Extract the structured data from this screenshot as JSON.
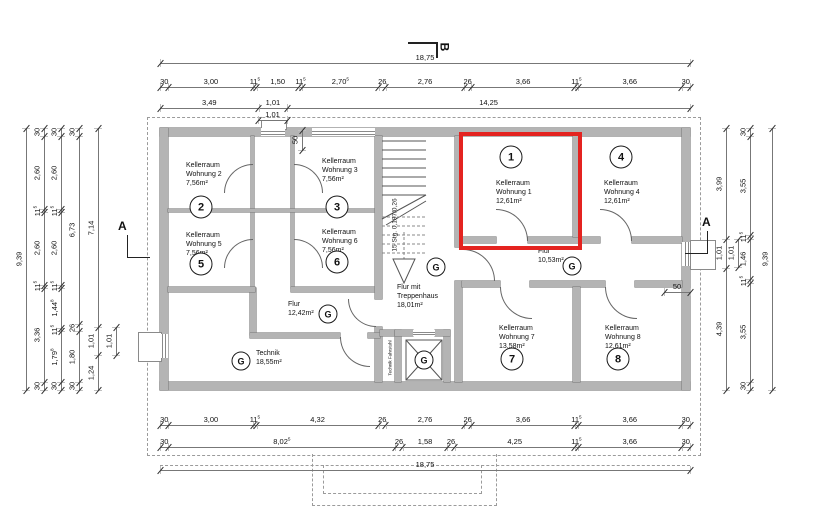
{
  "markers": {
    "a": "A",
    "b": "B"
  },
  "symbols": {
    "drain": "G"
  },
  "rooms": {
    "r1": {
      "circle": "1",
      "line1": "Kellerraum",
      "line2": "Wohnung 1",
      "area": "12,61m²"
    },
    "r2": {
      "circle": "2",
      "line1": "Kellerraum",
      "line2": "Wohnung 2",
      "area": "7,56m²"
    },
    "r3": {
      "circle": "3",
      "line1": "Kellerraum",
      "line2": "Wohnung 3",
      "area": "7,56m²"
    },
    "r4": {
      "circle": "4",
      "line1": "Kellerraum",
      "line2": "Wohnung 4",
      "area": "12,61m²"
    },
    "r5": {
      "circle": "5",
      "line1": "Kellerraum",
      "line2": "Wohnung 5",
      "area": "7,56m²"
    },
    "r6": {
      "circle": "6",
      "line1": "Kellerraum",
      "line2": "Wohnung 6",
      "area": "7,56m²"
    },
    "r7": {
      "circle": "7",
      "line1": "Kellerraum",
      "line2": "Wohnung 7",
      "area": "13,58m²"
    },
    "r8": {
      "circle": "8",
      "line1": "Kellerraum",
      "line2": "Wohnung 8",
      "area": "12,61m²"
    }
  },
  "corridors": {
    "flur1": {
      "name": "Flur",
      "area": "10,53m²"
    },
    "flur2": {
      "name": "Flur",
      "area": "12,42m²"
    },
    "technik": {
      "name": "Technik",
      "area": "18,55m²"
    },
    "treppe": {
      "line1": "Flur mit",
      "line2": "Treppenhaus",
      "area": "18,01m²"
    }
  },
  "stair": {
    "note": "15 Stg. 0,187/0,26"
  },
  "elevator": {
    "note": "Technik Fahrstuhl"
  },
  "dims": [
    {
      "id": "top1",
      "items": [
        {
          "l": "18,75",
          "v": 18.75
        }
      ]
    },
    {
      "id": "top2",
      "items": [
        {
          "l": "30",
          "v": 0.3
        },
        {
          "l": "3,00",
          "v": 3.0
        },
        {
          "l": "11",
          "s": "5",
          "v": 0.115
        },
        {
          "l": "1,50",
          "v": 1.5
        },
        {
          "l": "11",
          "s": "5",
          "v": 0.115
        },
        {
          "l": "2,70",
          "s": "5",
          "v": 2.705
        },
        {
          "l": "26",
          "v": 0.26
        },
        {
          "l": "2,76",
          "v": 2.76
        },
        {
          "l": "26",
          "v": 0.26
        },
        {
          "l": "3,66",
          "v": 3.66
        },
        {
          "l": "11",
          "s": "5",
          "v": 0.115
        },
        {
          "l": "3,66",
          "v": 3.66
        },
        {
          "l": "30",
          "v": 0.3
        }
      ]
    },
    {
      "id": "top3",
      "items": [
        {
          "l": "3,49",
          "v": 3.49
        },
        {
          "l": "1,01",
          "v": 1.01
        },
        {
          "l": "14,25",
          "v": 14.25
        }
      ]
    },
    {
      "id": "top4",
      "items": [
        {
          "l": "1,01",
          "v": 1.01
        }
      ]
    },
    {
      "id": "top50",
      "items": [
        {
          "l": "50",
          "v": 0.5
        }
      ]
    },
    {
      "id": "bot1",
      "items": [
        {
          "l": "30",
          "v": 0.3
        },
        {
          "l": "3,00",
          "v": 3.0
        },
        {
          "l": "11",
          "s": "5",
          "v": 0.115
        },
        {
          "l": "4,32",
          "v": 4.32
        },
        {
          "l": "26",
          "v": 0.26
        },
        {
          "l": "2,76",
          "v": 2.76
        },
        {
          "l": "26",
          "v": 0.26
        },
        {
          "l": "3,66",
          "v": 3.66
        },
        {
          "l": "11",
          "s": "5",
          "v": 0.115
        },
        {
          "l": "3,66",
          "v": 3.66
        },
        {
          "l": "30",
          "v": 0.3
        }
      ]
    },
    {
      "id": "bot2",
      "items": [
        {
          "l": "30",
          "v": 0.3
        },
        {
          "l": "8,02",
          "s": "5",
          "v": 8.025
        },
        {
          "l": "26",
          "v": 0.26
        },
        {
          "l": "1,58",
          "v": 1.58
        },
        {
          "l": "26",
          "v": 0.26
        },
        {
          "l": "4,25",
          "v": 4.25
        },
        {
          "l": "11",
          "s": "5",
          "v": 0.115
        },
        {
          "l": "3,66",
          "v": 3.66
        },
        {
          "l": "30",
          "v": 0.3
        }
      ]
    },
    {
      "id": "bot3",
      "items": [
        {
          "l": "18,75",
          "v": 18.75
        }
      ]
    },
    {
      "id": "leftA",
      "items": [
        {
          "l": "9,39",
          "v": 9.39
        }
      ]
    },
    {
      "id": "leftB",
      "items": [
        {
          "l": "30",
          "v": 0.3
        },
        {
          "l": "2,60",
          "v": 2.6
        },
        {
          "l": "11",
          "s": "5",
          "v": 0.115
        },
        {
          "l": "2,60",
          "v": 2.6
        },
        {
          "l": "11",
          "s": "5",
          "v": 0.115
        },
        {
          "l": "3,36",
          "v": 3.36
        },
        {
          "l": "30",
          "v": 0.3
        }
      ]
    },
    {
      "id": "leftC",
      "items": [
        {
          "l": "30",
          "v": 0.3
        },
        {
          "l": "2,60",
          "v": 2.6
        },
        {
          "l": "11",
          "s": "5",
          "v": 0.115
        },
        {
          "l": "2,60",
          "v": 2.6
        },
        {
          "l": "11",
          "s": "5",
          "v": 0.115
        },
        {
          "l": "1,44",
          "s": "8",
          "v": 1.448
        },
        {
          "l": "11",
          "s": "5",
          "v": 0.115
        },
        {
          "l": "1,79",
          "s": "8",
          "v": 1.798
        },
        {
          "l": "30",
          "v": 0.3
        }
      ]
    },
    {
      "id": "leftD",
      "items": [
        {
          "l": "30",
          "v": 0.3
        },
        {
          "l": "6,73",
          "v": 6.73
        },
        {
          "l": "26",
          "v": 0.26
        },
        {
          "l": "1,80",
          "v": 1.8
        },
        {
          "l": "30",
          "v": 0.3
        }
      ]
    },
    {
      "id": "leftE",
      "items": [
        {
          "l": "7,14",
          "v": 7.14
        },
        {
          "l": "1,01",
          "v": 1.01
        },
        {
          "l": "1,24",
          "v": 1.24
        }
      ]
    },
    {
      "id": "leftF",
      "items": [
        {
          "l": "1,01",
          "v": 1.01
        }
      ]
    },
    {
      "id": "rightG",
      "items": [
        {
          "l": "3,99",
          "v": 3.99
        },
        {
          "l": "1,01",
          "v": 1.01
        },
        {
          "l": "4,39",
          "v": 4.39
        }
      ]
    },
    {
      "id": "rightH",
      "items": [
        {
          "l": "30",
          "v": 0.3
        },
        {
          "l": "3,55",
          "v": 3.55
        },
        {
          "l": "11",
          "s": "5",
          "v": 0.115
        },
        {
          "l": "1,46",
          "v": 1.46
        },
        {
          "l": "11",
          "s": "5",
          "v": 0.115
        },
        {
          "l": "3,55",
          "v": 3.55
        },
        {
          "l": "30",
          "v": 0.3
        }
      ]
    },
    {
      "id": "rightH2",
      "items": [
        {
          "l": "1,01",
          "v": 1.01
        }
      ]
    },
    {
      "id": "rightI",
      "items": [
        {
          "l": "9,39",
          "v": 9.39
        }
      ]
    },
    {
      "id": "right50",
      "items": [
        {
          "l": "50",
          "v": 0.5
        }
      ]
    }
  ]
}
